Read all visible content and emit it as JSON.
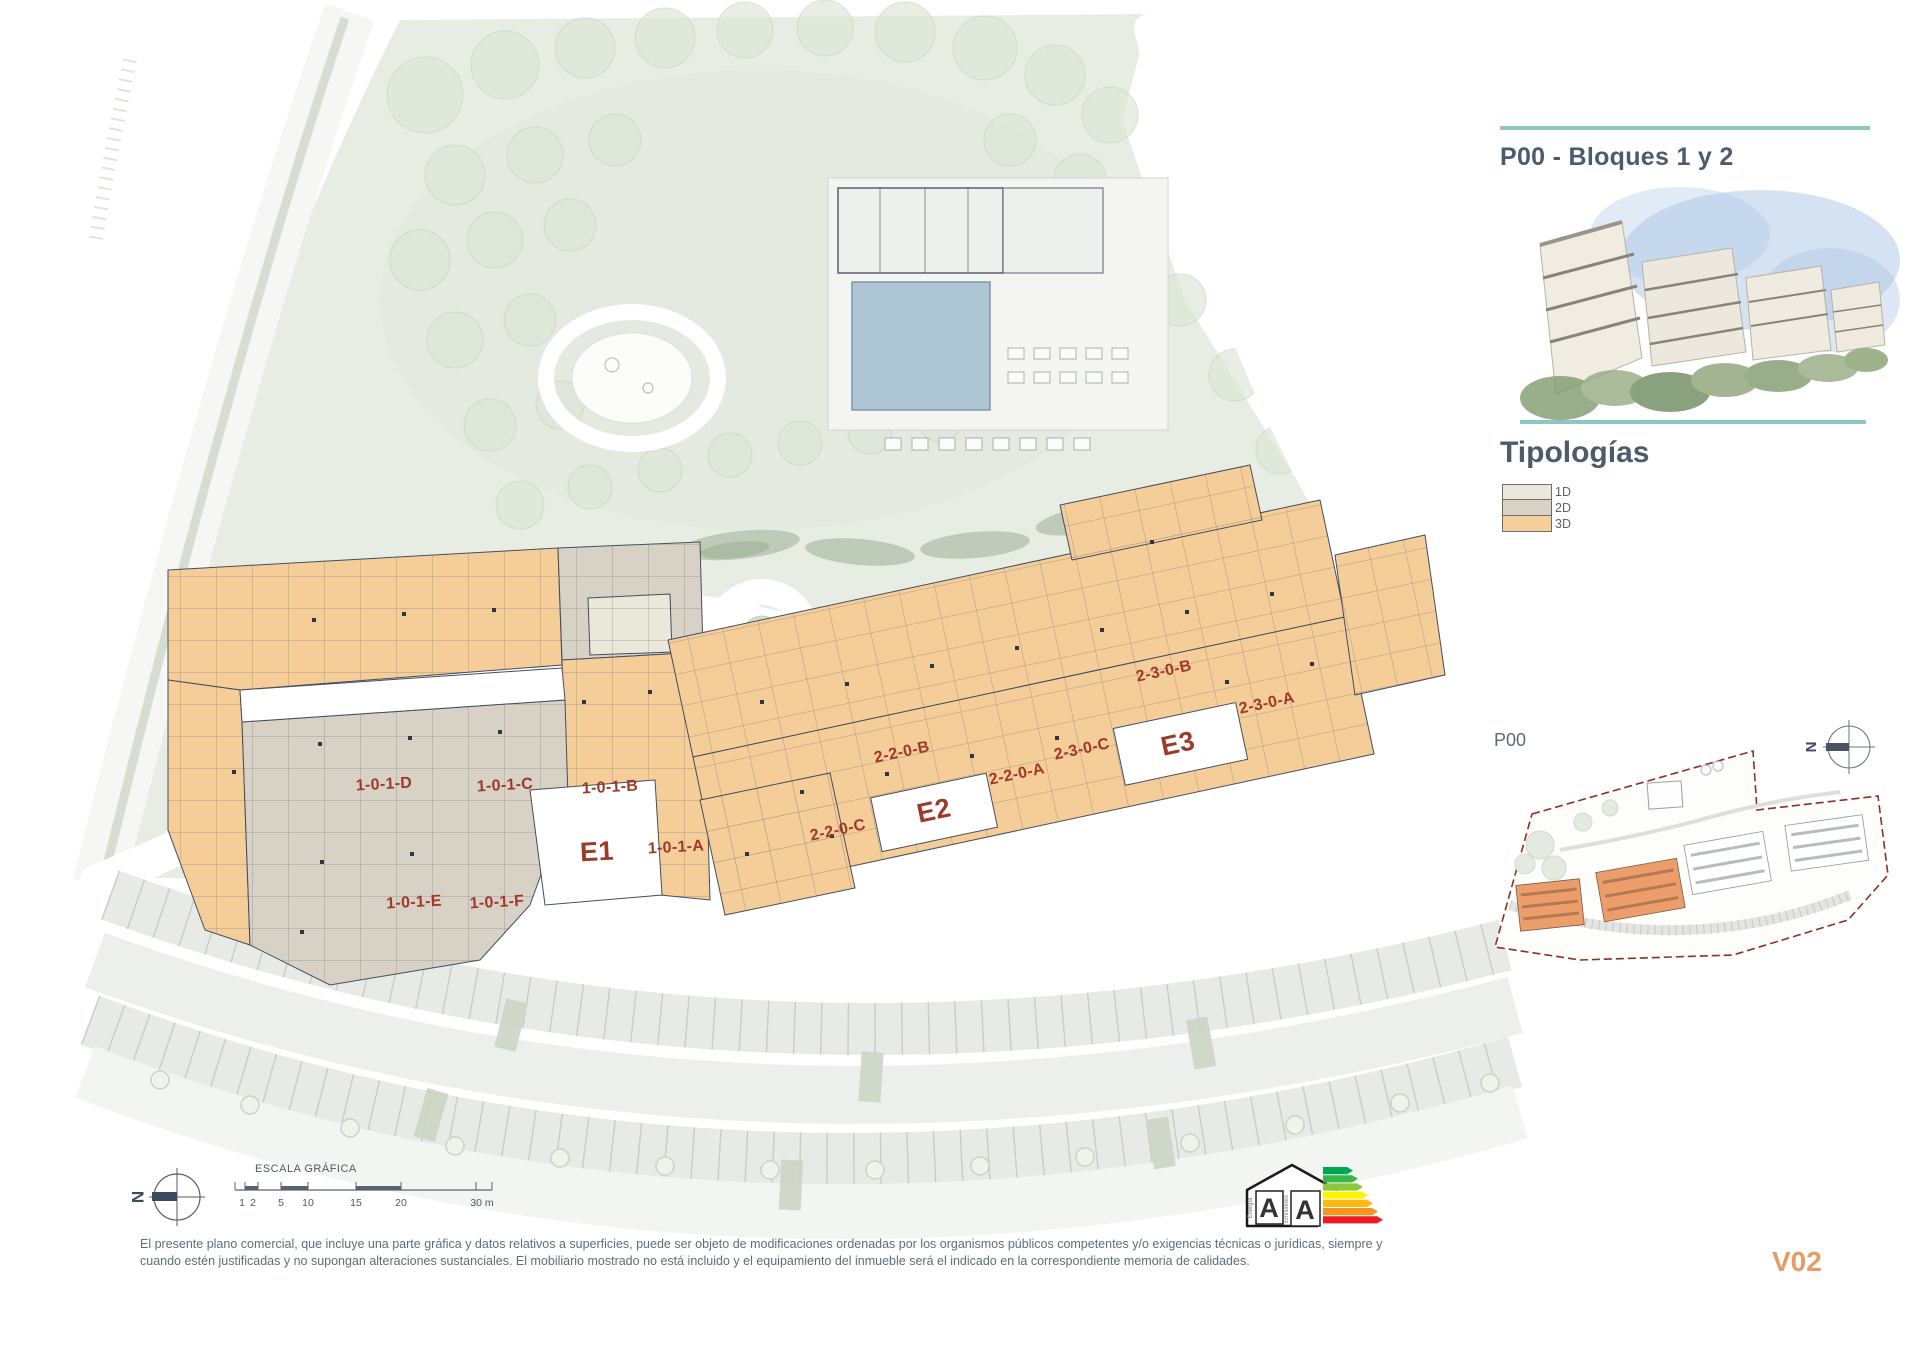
{
  "header": {
    "title": "P00 - Bloques 1 y 2"
  },
  "typologies": {
    "heading": "Tipologías",
    "items": [
      {
        "label": "1D",
        "color": "#eae8db"
      },
      {
        "label": "2D",
        "color": "#d8d1c5"
      },
      {
        "label": "3D",
        "color": "#f5cf9c"
      }
    ]
  },
  "plan": {
    "entrances": {
      "e1": "E1",
      "e2": "E2",
      "e3": "E3"
    },
    "units": {
      "u1a": "1-0-1-A",
      "u1b": "1-0-1-B",
      "u1c": "1-0-1-C",
      "u1d": "1-0-1-D",
      "u1e": "1-0-1-E",
      "u1f": "1-0-1-F",
      "u22a": "2-2-0-A",
      "u22b": "2-2-0-B",
      "u22c": "2-2-0-C",
      "u23a": "2-3-0-A",
      "u23b": "2-3-0-B",
      "u23c": "2-3-0-C"
    }
  },
  "minimap": {
    "label": "P00",
    "north": "N"
  },
  "scale_bar": {
    "title": "ESCALA GRÁFICA",
    "ticks": [
      "1",
      "2",
      "5",
      "10",
      "15",
      "20",
      "30 m"
    ]
  },
  "compass": {
    "north": "N"
  },
  "energy": {
    "energy_letter": "A",
    "emissions_letter": "A",
    "energy_axis": "Energía",
    "emissions_axis": "Emisiones"
  },
  "footer": {
    "disclaimer_line1": "El presente plano comercial, que incluye una parte gráfica y datos relativos a superficies, puede ser objeto de modificaciones ordenadas por los organismos públicos competentes y/o exigencias técnicas o jurídicas, siempre y",
    "disclaimer_line2": "cuando estén justificadas y no supongan alteraciones sustanciales. El mobiliario mostrado no está incluido y el equipamiento del inmueble será el indicado en la correspondiente memoria de calidades.",
    "version": "V02"
  },
  "colors": {
    "accent_teal": "#8fc6c4",
    "heading": "#4d5c6c",
    "unit_label": "#9d3a29",
    "typology_1d": "#eae8db",
    "typology_2d": "#d8d1c5",
    "typology_3d": "#f5cf9c",
    "version": "#e99b66",
    "boundary_red": "#8c3026"
  }
}
